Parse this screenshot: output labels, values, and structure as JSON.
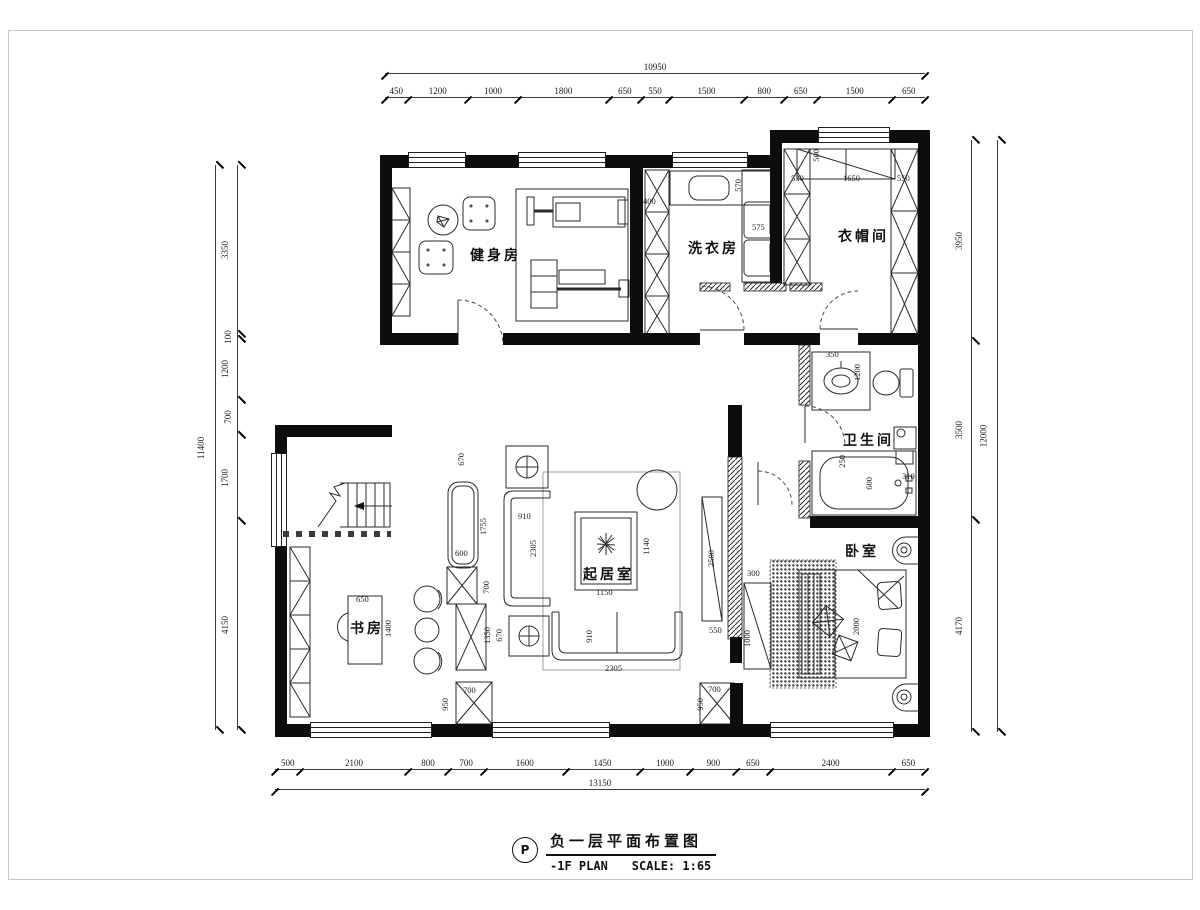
{
  "rooms": [
    {
      "id": "gym",
      "label": "健身房"
    },
    {
      "id": "laundry",
      "label": "洗衣房"
    },
    {
      "id": "cloakroom",
      "label": "衣帽间"
    },
    {
      "id": "bathroom",
      "label": "卫生间"
    },
    {
      "id": "bedroom",
      "label": "卧室"
    },
    {
      "id": "living-room",
      "label": "起居室"
    },
    {
      "id": "study",
      "label": "书房"
    }
  ],
  "dims": {
    "top": {
      "total": "10950",
      "segments": [
        "450",
        "1200",
        "1000",
        "1800",
        "650",
        "550",
        "1500",
        "800",
        "650",
        "1500",
        "650"
      ]
    },
    "bottom": {
      "total": "13150",
      "segments": [
        "500",
        "2100",
        "800",
        "700",
        "1600",
        "1450",
        "1000",
        "900",
        "650",
        "2400",
        "650"
      ]
    },
    "left": {
      "total": "11400",
      "segments": [
        "3350",
        "100",
        "1200",
        "700",
        "1700",
        "4150"
      ]
    },
    "right": {
      "total": "12000",
      "segments": [
        "3950",
        "3500",
        "4170"
      ]
    },
    "interior": [
      "400",
      "570",
      "575",
      "530",
      "500",
      "1650",
      "550",
      "350",
      "1200",
      "250",
      "600",
      "310",
      "670",
      "910",
      "2305",
      "1755",
      "600",
      "700",
      "1350",
      "670",
      "1140",
      "1150",
      "910",
      "2305",
      "700",
      "950",
      "650",
      "1400",
      "2500",
      "550",
      "300",
      "1000",
      "700",
      "950",
      "2000"
    ]
  },
  "title_block": {
    "bubble": "P",
    "title_cn": "负一层平面布置图",
    "subtitle_en": "-1F PLAN",
    "scale_label": "SCALE: 1:65"
  }
}
